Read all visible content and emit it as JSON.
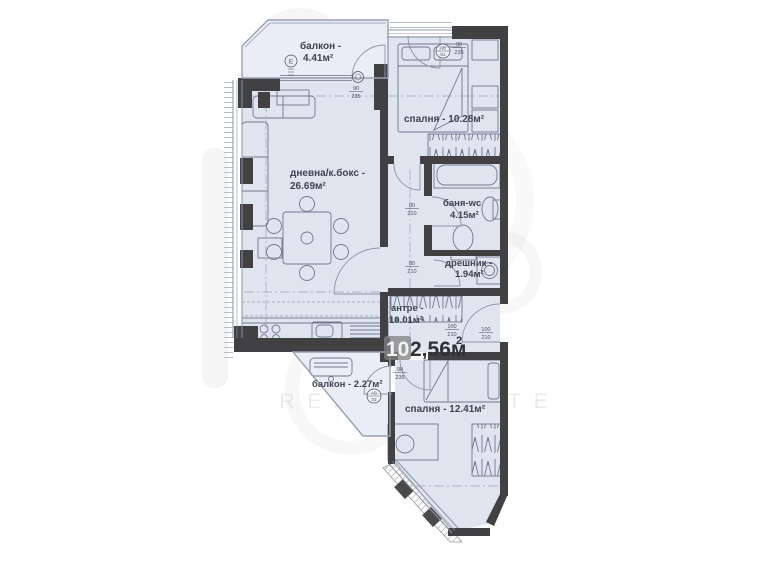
{
  "watermark": {
    "text": "REAL ESTATE"
  },
  "total": {
    "prefix": "10",
    "main": "2,56м",
    "sup": "2"
  },
  "rooms": {
    "balcony1": {
      "line1": "балкон -",
      "line2": "4.41м²"
    },
    "bedroom1": {
      "label": "спалня - 10.28м²"
    },
    "living": {
      "line1": "дневна/к.бокс -",
      "line2": "26.69м²"
    },
    "bath": {
      "line1": "баня-wc",
      "line2": "4.15м²"
    },
    "closet": {
      "line1": "дрешник -",
      "line2": "1.94м²"
    },
    "hall": {
      "line1": "антре -",
      "line2": "10.01м²"
    },
    "balcony2": {
      "label": "балкон - 2.27м²"
    },
    "bedroom2": {
      "label": "спалня - 12.41м²"
    }
  },
  "dims": {
    "d1": {
      "top": "90",
      "bottom": "235"
    },
    "d2": {
      "top": "80",
      "bottom": "210"
    },
    "d3": {
      "top": "80",
      "bottom": "210"
    },
    "d4": {
      "top": "100",
      "bottom": "210"
    },
    "d5": {
      "top": "100",
      "bottom": "210"
    },
    "d6": {
      "top": "90",
      "bottom": "235"
    },
    "d7": {
      "top": "90",
      "bottom": "235"
    }
  },
  "markers": {
    "m1": "Е",
    "m2": {
      "top": "АВ",
      "bottom": "01"
    },
    "m3": {
      "top": "АВ",
      "bottom": "03"
    }
  },
  "colors": {
    "floor": "#dfe4ef",
    "balcony_floor": "#e9edf5",
    "wall": "#414144",
    "line": "#8a93a8",
    "label": "#3f4450"
  }
}
